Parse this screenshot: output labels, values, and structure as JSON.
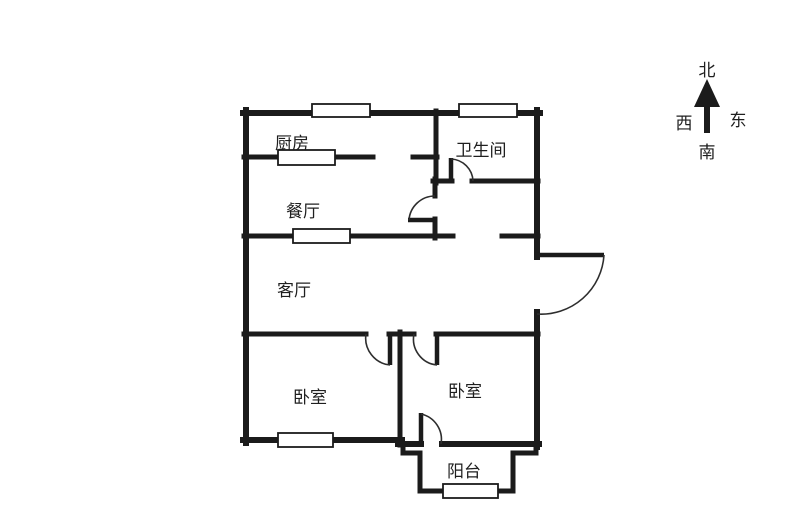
{
  "colors": {
    "wall": "#1b1b1b",
    "line": "#2e2e2e",
    "bg": "#ffffff",
    "text": "#1f1f1f"
  },
  "rooms": {
    "kitchen": "厨房",
    "bathroom": "卫生间",
    "dining": "餐厅",
    "living": "客厅",
    "bedroom_left": "卧室",
    "bedroom_right": "卧室",
    "balcony": "阳台"
  },
  "compass": {
    "north": "北",
    "west": "西",
    "east": "东",
    "south": "南"
  }
}
